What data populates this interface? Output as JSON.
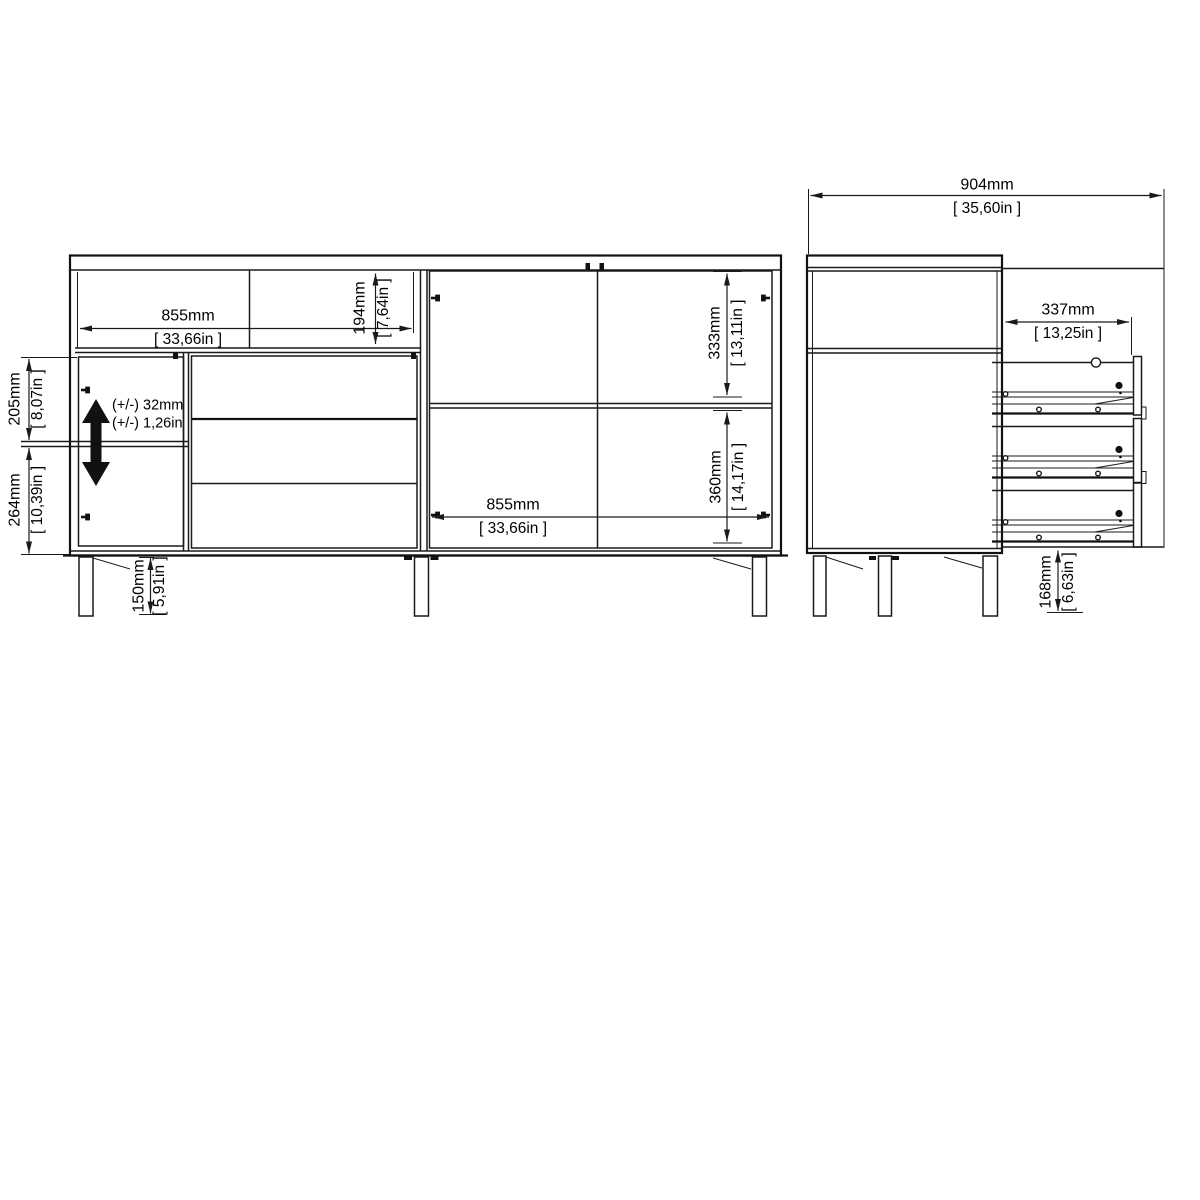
{
  "front_view": {
    "top_width_mm": "855mm",
    "top_width_in": "[ 33,66in ]",
    "top_opening_height_mm": "194mm",
    "top_opening_height_in": "[ 7,64in ]",
    "left_upper_mm": "205mm",
    "left_upper_in": "[ 8,07in ]",
    "left_lower_mm": "264mm",
    "left_lower_in": "[ 10,39in ]",
    "shelf_adjust_mm": "(+/-) 32mm",
    "shelf_adjust_in": "(+/-) 1,26in",
    "leg_height_mm": "150mm",
    "leg_height_in": "[ 5,91in ]",
    "right_upper_mm": "333mm",
    "right_upper_in": "[ 13,11in ]",
    "right_lower_mm": "360mm",
    "right_lower_in": "[ 14,17in ]",
    "bottom_width_mm": "855mm",
    "bottom_width_in": "[ 33,66in ]"
  },
  "side_view": {
    "depth_open_mm": "904mm",
    "depth_open_in": "[ 35,60in ]",
    "drawer_extension_mm": "337mm",
    "drawer_extension_in": "[ 13,25in ]",
    "leg_height_mm": "168mm",
    "leg_height_in": "[ 6,63in ]"
  },
  "style": {
    "line_color": "#1a1a1a",
    "background": "#ffffff"
  }
}
